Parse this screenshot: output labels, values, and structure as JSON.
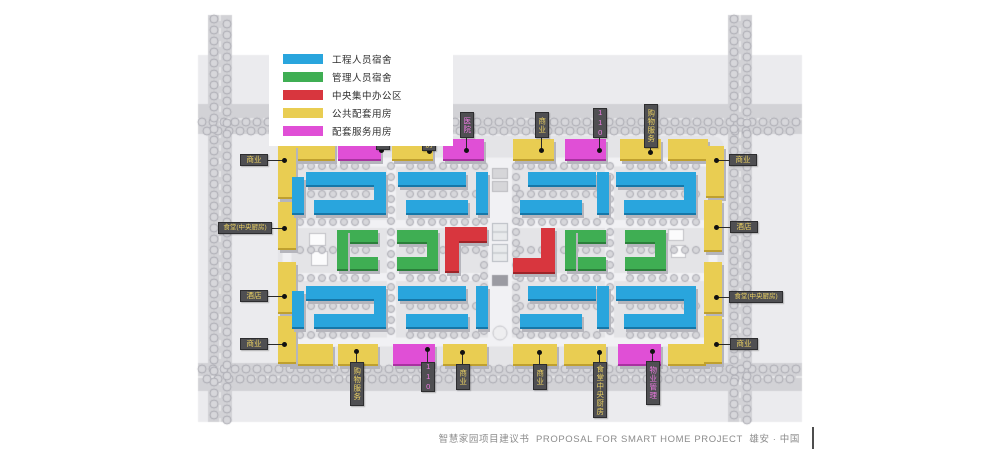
{
  "page": {
    "caption_zh": "智慧家园项目建议书",
    "caption_en": "PROPOSAL FOR SMART HOME PROJECT",
    "caption_loc": "雄安 · 中国"
  },
  "palette": {
    "eng": "#29a5dd",
    "mgmt": "#3fae53",
    "office": "#d8363e",
    "public": "#e9cd52",
    "service": "#e04fd6",
    "tag_bg": "#4f4f52",
    "road": "#d2d2d6",
    "panel": "#ebebee"
  },
  "legend": {
    "items": [
      {
        "label": "工程人员宿舍",
        "type": "eng"
      },
      {
        "label": "管理人员宿舍",
        "type": "mgmt"
      },
      {
        "label": "中央集中办公区",
        "type": "office"
      },
      {
        "label": "公共配套用房",
        "type": "public"
      },
      {
        "label": "配套服务用房",
        "type": "service"
      }
    ]
  },
  "site": {
    "buildings": [
      {
        "x": 288,
        "y": 139,
        "w": 47,
        "h": 20,
        "type": "public"
      },
      {
        "x": 338,
        "y": 139,
        "w": 43,
        "h": 20,
        "type": "service"
      },
      {
        "x": 392,
        "y": 139,
        "w": 41,
        "h": 20,
        "type": "public"
      },
      {
        "x": 443,
        "y": 139,
        "w": 41,
        "h": 20,
        "type": "service"
      },
      {
        "x": 513,
        "y": 139,
        "w": 41,
        "h": 20,
        "type": "public"
      },
      {
        "x": 565,
        "y": 139,
        "w": 41,
        "h": 20,
        "type": "service"
      },
      {
        "x": 620,
        "y": 139,
        "w": 41,
        "h": 20,
        "type": "public"
      },
      {
        "x": 668,
        "y": 139,
        "w": 40,
        "h": 20,
        "type": "public"
      },
      {
        "x": 288,
        "y": 344,
        "w": 45,
        "h": 20,
        "type": "public"
      },
      {
        "x": 338,
        "y": 344,
        "w": 40,
        "h": 20,
        "type": "public"
      },
      {
        "x": 393,
        "y": 344,
        "w": 42,
        "h": 20,
        "type": "service"
      },
      {
        "x": 443,
        "y": 344,
        "w": 44,
        "h": 20,
        "type": "public"
      },
      {
        "x": 513,
        "y": 344,
        "w": 44,
        "h": 20,
        "type": "public"
      },
      {
        "x": 564,
        "y": 344,
        "w": 42,
        "h": 20,
        "type": "public"
      },
      {
        "x": 618,
        "y": 344,
        "w": 43,
        "h": 20,
        "type": "service"
      },
      {
        "x": 668,
        "y": 344,
        "w": 40,
        "h": 20,
        "type": "public"
      },
      {
        "x": 278,
        "y": 145,
        "w": 18,
        "h": 52,
        "type": "public"
      },
      {
        "x": 278,
        "y": 202,
        "w": 18,
        "h": 46,
        "type": "public"
      },
      {
        "x": 278,
        "y": 262,
        "w": 18,
        "h": 50,
        "type": "public"
      },
      {
        "x": 278,
        "y": 316,
        "w": 18,
        "h": 46,
        "type": "public"
      },
      {
        "x": 706,
        "y": 146,
        "w": 18,
        "h": 50,
        "type": "public"
      },
      {
        "x": 704,
        "y": 200,
        "w": 18,
        "h": 50,
        "type": "public"
      },
      {
        "x": 704,
        "y": 262,
        "w": 18,
        "h": 50,
        "type": "public"
      },
      {
        "x": 704,
        "y": 316,
        "w": 18,
        "h": 46,
        "type": "public"
      },
      {
        "x": 306,
        "y": 172,
        "w": 68,
        "h": 13,
        "type": "eng"
      },
      {
        "x": 314,
        "y": 200,
        "w": 62,
        "h": 13,
        "type": "eng"
      },
      {
        "x": 374,
        "y": 172,
        "w": 12,
        "h": 41,
        "type": "eng"
      },
      {
        "x": 292,
        "y": 177,
        "w": 12,
        "h": 36,
        "type": "eng"
      },
      {
        "x": 398,
        "y": 172,
        "w": 68,
        "h": 13,
        "type": "eng"
      },
      {
        "x": 406,
        "y": 200,
        "w": 62,
        "h": 13,
        "type": "eng"
      },
      {
        "x": 476,
        "y": 172,
        "w": 12,
        "h": 41,
        "type": "eng"
      },
      {
        "x": 528,
        "y": 172,
        "w": 68,
        "h": 13,
        "type": "eng"
      },
      {
        "x": 520,
        "y": 200,
        "w": 62,
        "h": 13,
        "type": "eng"
      },
      {
        "x": 597,
        "y": 172,
        "w": 12,
        "h": 41,
        "type": "eng"
      },
      {
        "x": 616,
        "y": 172,
        "w": 68,
        "h": 13,
        "type": "eng"
      },
      {
        "x": 624,
        "y": 200,
        "w": 62,
        "h": 13,
        "type": "eng"
      },
      {
        "x": 684,
        "y": 172,
        "w": 12,
        "h": 41,
        "type": "eng"
      },
      {
        "x": 306,
        "y": 286,
        "w": 68,
        "h": 13,
        "type": "eng"
      },
      {
        "x": 314,
        "y": 314,
        "w": 62,
        "h": 13,
        "type": "eng"
      },
      {
        "x": 374,
        "y": 286,
        "w": 12,
        "h": 41,
        "type": "eng"
      },
      {
        "x": 292,
        "y": 291,
        "w": 12,
        "h": 36,
        "type": "eng"
      },
      {
        "x": 398,
        "y": 286,
        "w": 68,
        "h": 13,
        "type": "eng"
      },
      {
        "x": 406,
        "y": 314,
        "w": 62,
        "h": 13,
        "type": "eng"
      },
      {
        "x": 476,
        "y": 286,
        "w": 12,
        "h": 41,
        "type": "eng"
      },
      {
        "x": 528,
        "y": 286,
        "w": 68,
        "h": 13,
        "type": "eng"
      },
      {
        "x": 520,
        "y": 314,
        "w": 62,
        "h": 13,
        "type": "eng"
      },
      {
        "x": 597,
        "y": 286,
        "w": 12,
        "h": 41,
        "type": "eng"
      },
      {
        "x": 616,
        "y": 286,
        "w": 68,
        "h": 13,
        "type": "eng"
      },
      {
        "x": 624,
        "y": 314,
        "w": 62,
        "h": 13,
        "type": "eng"
      },
      {
        "x": 684,
        "y": 286,
        "w": 12,
        "h": 41,
        "type": "eng"
      },
      {
        "x": 337,
        "y": 230,
        "w": 41,
        "h": 12,
        "type": "mgmt"
      },
      {
        "x": 337,
        "y": 257,
        "w": 41,
        "h": 12,
        "type": "mgmt"
      },
      {
        "x": 337,
        "y": 230,
        "w": 11,
        "h": 39,
        "type": "mgmt"
      },
      {
        "x": 397,
        "y": 230,
        "w": 41,
        "h": 12,
        "type": "mgmt"
      },
      {
        "x": 397,
        "y": 257,
        "w": 41,
        "h": 12,
        "type": "mgmt"
      },
      {
        "x": 427,
        "y": 230,
        "w": 11,
        "h": 39,
        "type": "mgmt"
      },
      {
        "x": 565,
        "y": 230,
        "w": 41,
        "h": 12,
        "type": "mgmt"
      },
      {
        "x": 565,
        "y": 257,
        "w": 41,
        "h": 12,
        "type": "mgmt"
      },
      {
        "x": 565,
        "y": 230,
        "w": 11,
        "h": 39,
        "type": "mgmt"
      },
      {
        "x": 625,
        "y": 230,
        "w": 41,
        "h": 12,
        "type": "mgmt"
      },
      {
        "x": 625,
        "y": 257,
        "w": 41,
        "h": 12,
        "type": "mgmt"
      },
      {
        "x": 655,
        "y": 230,
        "w": 11,
        "h": 39,
        "type": "mgmt"
      },
      {
        "x": 445,
        "y": 227,
        "w": 42,
        "h": 14,
        "type": "office"
      },
      {
        "x": 445,
        "y": 241,
        "w": 14,
        "h": 30,
        "type": "office"
      },
      {
        "x": 541,
        "y": 228,
        "w": 14,
        "h": 30,
        "type": "office"
      },
      {
        "x": 513,
        "y": 258,
        "w": 42,
        "h": 14,
        "type": "office"
      }
    ],
    "tags": [
      {
        "label": "物业管理",
        "color": "magenta",
        "side": "top",
        "x": 376,
        "y": 106,
        "w": 14,
        "h": 44,
        "dot": [
          381,
          150
        ]
      },
      {
        "label": "食堂中央厨房",
        "color": "yellow",
        "side": "top",
        "x": 422,
        "y": 95,
        "w": 14,
        "h": 56,
        "dot": [
          429,
          151
        ]
      },
      {
        "label": "医院",
        "color": "magenta",
        "side": "top",
        "x": 460,
        "y": 112,
        "w": 14,
        "h": 26,
        "dot": [
          466,
          150
        ]
      },
      {
        "label": "商业",
        "color": "yellow",
        "side": "top",
        "x": 535,
        "y": 112,
        "w": 14,
        "h": 26,
        "dot": [
          541,
          150
        ]
      },
      {
        "label": "110",
        "color": "magenta",
        "side": "top",
        "x": 593,
        "y": 108,
        "w": 14,
        "h": 30,
        "dot": [
          599,
          150
        ]
      },
      {
        "label": "购物服务",
        "color": "yellow",
        "side": "top",
        "x": 644,
        "y": 104,
        "w": 14,
        "h": 44,
        "dot": [
          650,
          152
        ]
      },
      {
        "label": "商业",
        "color": "yellow",
        "side": "right",
        "x": 729,
        "y": 154,
        "w": 28,
        "h": 12,
        "dot": [
          716,
          160
        ]
      },
      {
        "label": "酒店",
        "color": "yellow",
        "side": "right",
        "x": 730,
        "y": 221,
        "w": 28,
        "h": 12,
        "dot": [
          716,
          227
        ]
      },
      {
        "label": "食堂(中央厨房)",
        "color": "yellow",
        "side": "right",
        "x": 729,
        "y": 291,
        "w": 54,
        "h": 12,
        "small": true,
        "dot": [
          716,
          297
        ]
      },
      {
        "label": "商业",
        "color": "yellow",
        "side": "right",
        "x": 730,
        "y": 338,
        "w": 28,
        "h": 12,
        "dot": [
          716,
          344
        ]
      },
      {
        "label": "商业",
        "color": "yellow",
        "side": "left",
        "x": 240,
        "y": 154,
        "w": 28,
        "h": 12,
        "dot": [
          284,
          160
        ]
      },
      {
        "label": "食堂(中央厨房)",
        "color": "yellow",
        "side": "left",
        "x": 218,
        "y": 222,
        "w": 54,
        "h": 12,
        "small": true,
        "dot": [
          284,
          228
        ]
      },
      {
        "label": "酒店",
        "color": "yellow",
        "side": "left",
        "x": 240,
        "y": 290,
        "w": 28,
        "h": 12,
        "dot": [
          284,
          296
        ]
      },
      {
        "label": "商业",
        "color": "yellow",
        "side": "left",
        "x": 240,
        "y": 338,
        "w": 28,
        "h": 12,
        "dot": [
          284,
          344
        ]
      },
      {
        "label": "购物服务",
        "color": "yellow",
        "side": "bottom",
        "x": 350,
        "y": 362,
        "w": 14,
        "h": 44,
        "dot": [
          356,
          351
        ]
      },
      {
        "label": "110",
        "color": "magenta",
        "side": "bottom",
        "x": 421,
        "y": 362,
        "w": 14,
        "h": 30,
        "dot": [
          427,
          349
        ]
      },
      {
        "label": "商业",
        "color": "yellow",
        "side": "bottom",
        "x": 456,
        "y": 364,
        "w": 14,
        "h": 26,
        "dot": [
          462,
          352
        ]
      },
      {
        "label": "商业",
        "color": "yellow",
        "side": "bottom",
        "x": 533,
        "y": 364,
        "w": 14,
        "h": 26,
        "dot": [
          539,
          352
        ]
      },
      {
        "label": "食堂中央厨房",
        "color": "yellow",
        "side": "bottom",
        "x": 593,
        "y": 362,
        "w": 14,
        "h": 56,
        "dot": [
          599,
          352
        ]
      },
      {
        "label": "物业管理",
        "color": "magenta",
        "side": "bottom",
        "x": 646,
        "y": 361,
        "w": 14,
        "h": 44,
        "dot": [
          652,
          351
        ]
      }
    ]
  }
}
